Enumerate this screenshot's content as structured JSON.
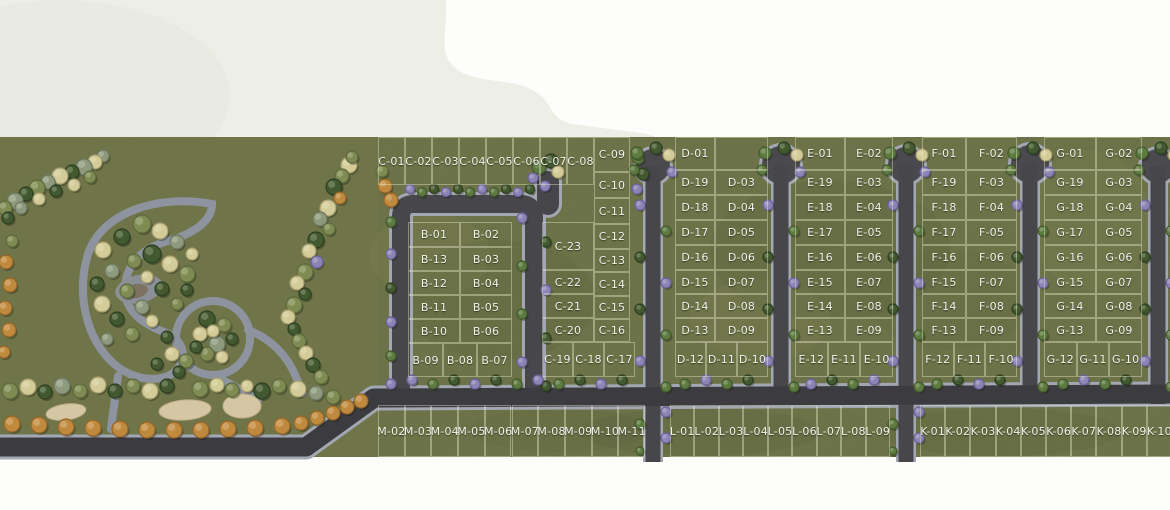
{
  "plan": {
    "palette": {
      "grass": "#6e7348",
      "road": "#47474b",
      "main_road": "#3c3c40",
      "curb": "#a2a7b1",
      "park_path": "#8f96a4",
      "sand": "#d5c7a3",
      "label_text": "#f3f3ec",
      "background": "#ffffff"
    },
    "blocks": {
      "B": {
        "rows": [
          [
            "B-01",
            "B-02"
          ],
          [
            "B-13",
            "B-03"
          ],
          [
            "B-12",
            "B-04"
          ],
          [
            "B-11",
            "B-05"
          ],
          [
            "B-10",
            "B-06"
          ]
        ],
        "bottom_row": [
          "B-09",
          "B-08",
          "B-07"
        ]
      },
      "C": {
        "top_row": [
          "C-01",
          "C-02",
          "C-03",
          "C-04",
          "C-05",
          "C-06",
          "C-07",
          "C-08"
        ],
        "right_column": [
          "C-09",
          "C-10",
          "C-11",
          "C-12",
          "C-13",
          "C-14",
          "C-15",
          "C-16"
        ],
        "inner_column": [
          "C-23",
          "C-22",
          "C-21",
          "C-20"
        ],
        "bottom_row": [
          "C-19",
          "C-18",
          "C-17"
        ]
      },
      "D": {
        "top_row": [
          "D-01",
          ""
        ],
        "rows": [
          [
            "D-19",
            "D-03"
          ],
          [
            "D-18",
            "D-04"
          ],
          [
            "D-17",
            "D-05"
          ],
          [
            "D-16",
            "D-06"
          ],
          [
            "D-15",
            "D-07"
          ],
          [
            "D-14",
            "D-08"
          ],
          [
            "D-13",
            "D-09"
          ]
        ],
        "bottom_row": [
          "D-12",
          "D-11",
          "D-10"
        ]
      },
      "E": {
        "top_row": [
          "E-01",
          "E-02"
        ],
        "rows": [
          [
            "E-19",
            "E-03"
          ],
          [
            "E-18",
            "E-04"
          ],
          [
            "E-17",
            "E-05"
          ],
          [
            "E-16",
            "E-06"
          ],
          [
            "E-15",
            "E-07"
          ],
          [
            "E-14",
            "E-08"
          ],
          [
            "E-13",
            "E-09"
          ]
        ],
        "bottom_row": [
          "E-12",
          "E-11",
          "E-10"
        ]
      },
      "F": {
        "top_row": [
          "F-01",
          "F-02"
        ],
        "rows": [
          [
            "F-19",
            "F-03"
          ],
          [
            "F-18",
            "F-04"
          ],
          [
            "F-17",
            "F-05"
          ],
          [
            "F-16",
            "F-06"
          ],
          [
            "F-15",
            "F-07"
          ],
          [
            "F-14",
            "F-08"
          ],
          [
            "F-13",
            "F-09"
          ]
        ],
        "bottom_row": [
          "F-12",
          "F-11",
          "F-10"
        ]
      },
      "G": {
        "top_row": [
          "G-01",
          "G-02"
        ],
        "rows": [
          [
            "G-19",
            "G-03"
          ],
          [
            "G-18",
            "G-04"
          ],
          [
            "G-17",
            "G-05"
          ],
          [
            "G-16",
            "G-06"
          ],
          [
            "G-15",
            "G-07"
          ],
          [
            "G-14",
            "G-08"
          ],
          [
            "G-13",
            "G-09"
          ]
        ],
        "bottom_row": [
          "G-12",
          "G-11",
          "G-10"
        ]
      },
      "M": {
        "strip": [
          "M-02",
          "M-03",
          "M-04",
          "M-05",
          "M-06",
          "M-07",
          "M-08",
          "M-09",
          "M-10",
          "M-11"
        ]
      },
      "L": {
        "strip": [
          "L-01",
          "L-02",
          "L-03",
          "L-04",
          "L-05",
          "L-06",
          "L-07",
          "L-08",
          "L-09"
        ]
      },
      "K": {
        "strip": [
          "K-01",
          "K-02",
          "K-03",
          "K-04",
          "K-05",
          "K-06",
          "K-07",
          "K-08",
          "K-09",
          "K-10"
        ]
      }
    }
  }
}
